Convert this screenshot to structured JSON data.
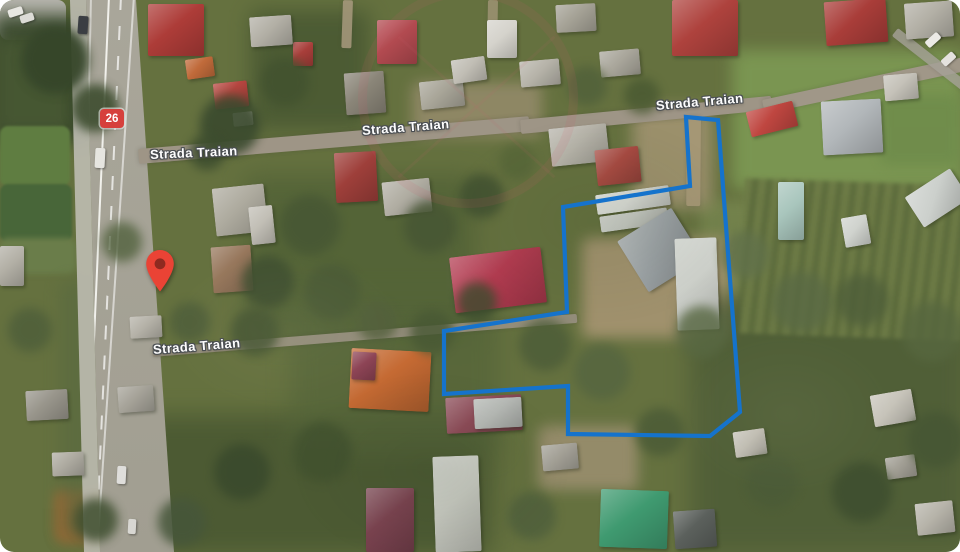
{
  "map": {
    "road_labels": [
      {
        "text": "Strada Traian",
        "x": 150,
        "y": 147,
        "rotation": -2.5
      },
      {
        "text": "Strada Traian",
        "x": 362,
        "y": 123,
        "rotation": -4.5
      },
      {
        "text": "Strada Traian",
        "x": 656,
        "y": 98,
        "rotation": -5
      },
      {
        "text": "Strada Traian",
        "x": 153,
        "y": 342,
        "rotation": -4.5
      }
    ],
    "route_badge": {
      "text": "26",
      "x": 100,
      "y": 109,
      "color": "#d6403c"
    },
    "marker": {
      "x": 145,
      "y": 249,
      "width": 30,
      "height": 44,
      "color": "#ea4335",
      "inner_color": "#8e2a20"
    },
    "property_boundary": {
      "color": "#1573cc",
      "stroke_width": 4.2,
      "points": [
        [
          686,
          117
        ],
        [
          718,
          120
        ],
        [
          740,
          412
        ],
        [
          710,
          436
        ],
        [
          568,
          434
        ],
        [
          568,
          386
        ],
        [
          444,
          394
        ],
        [
          444,
          331
        ],
        [
          567,
          312
        ],
        [
          563,
          207
        ],
        [
          690,
          186
        ]
      ]
    }
  }
}
